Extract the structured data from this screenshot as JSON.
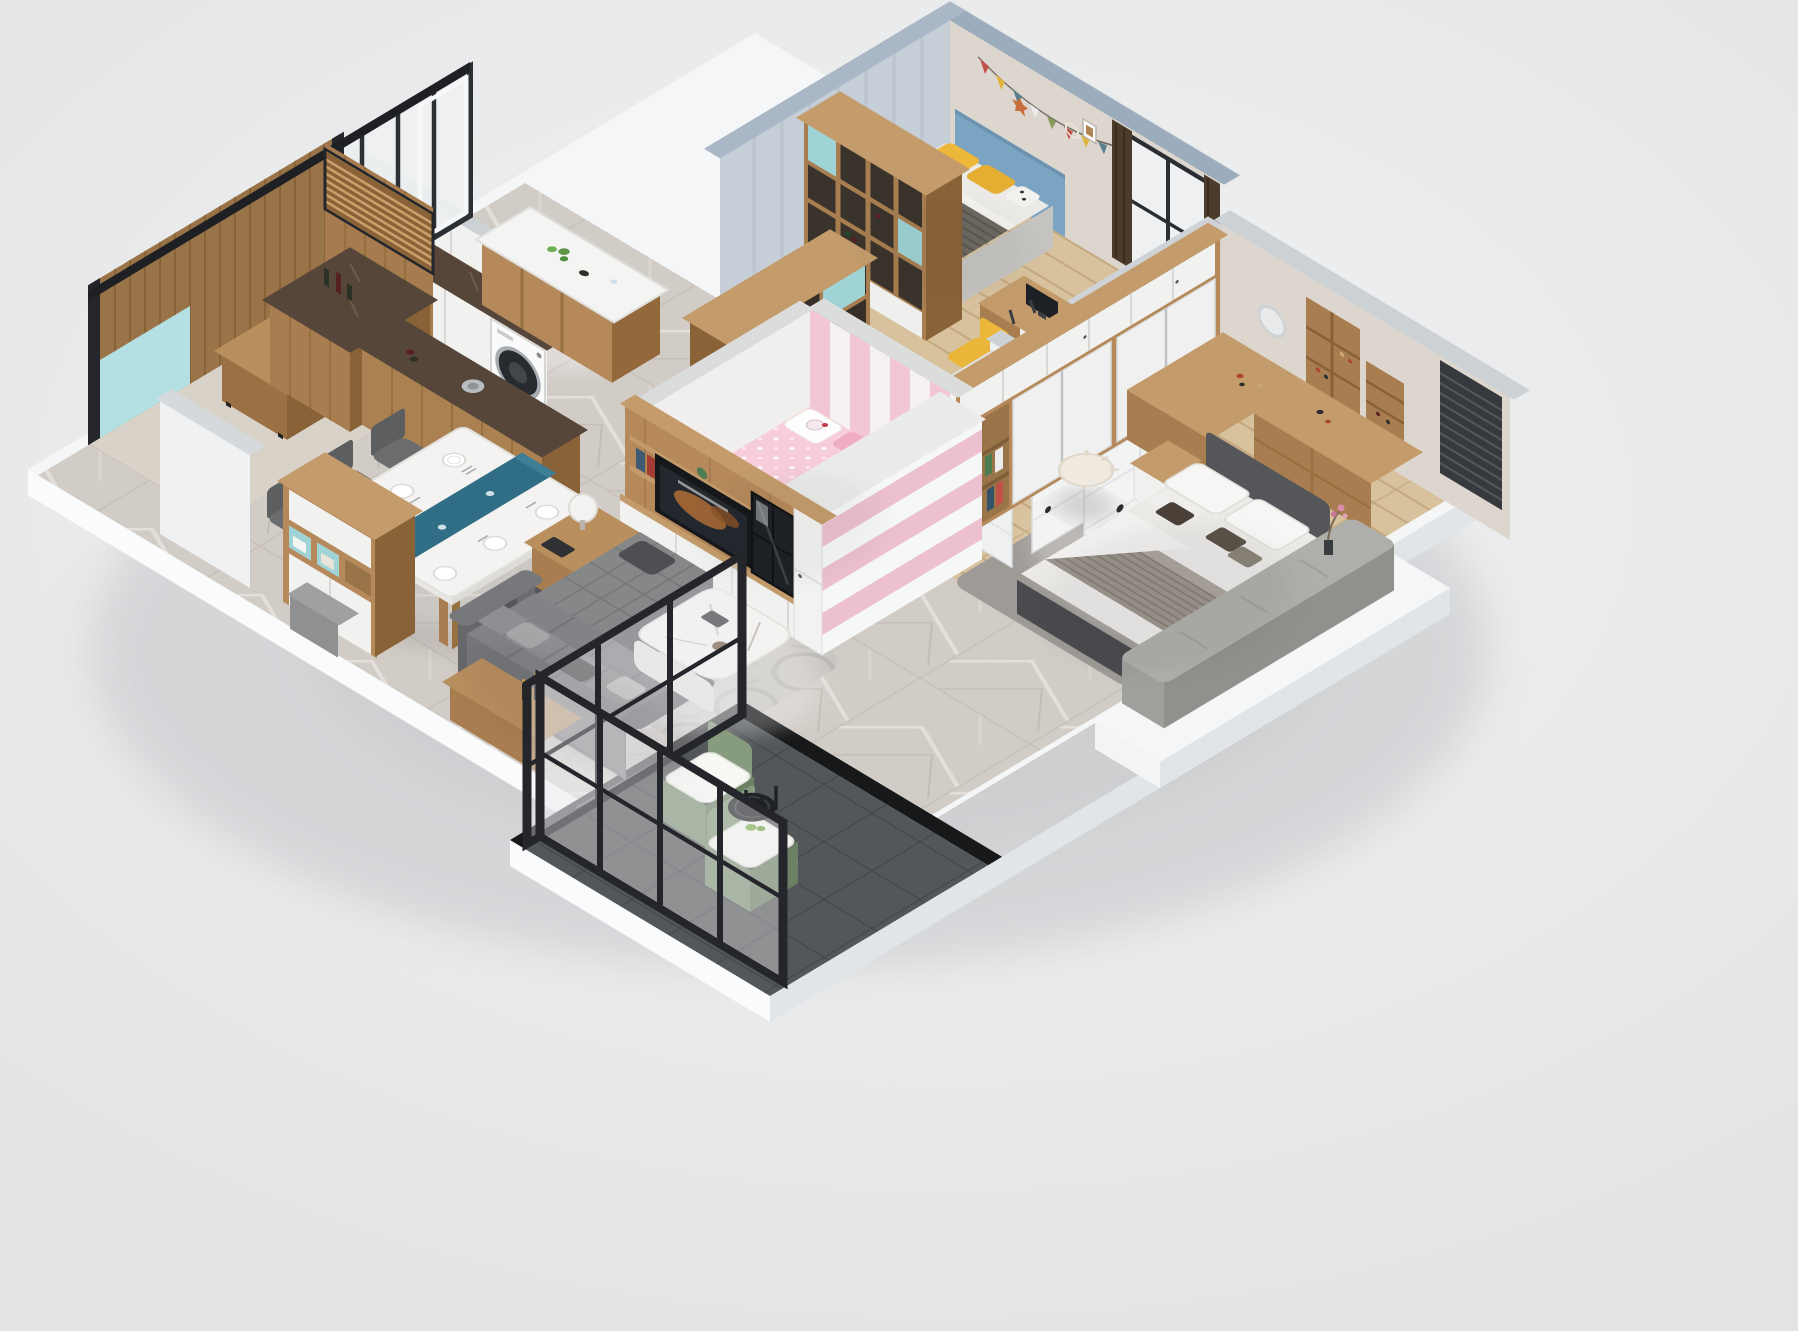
{
  "scene": {
    "type": "isometric-3d-apartment-floorplan-render",
    "description": "Cutaway d​ollhouse-style 3D render of a furnished apartment viewed from above at an angle, on a plain light gray background. No text is visible in the image.",
    "rooms": [
      {
        "name": "living-room",
        "floor": "gray marble tile with patterned rug",
        "furniture": [
          "gray L-shaped sectional sofa",
          "chaise lounge",
          "white organic marble coffee table",
          "wood side table with white ball lamp",
          "wood console with candlesticks"
        ]
      },
      {
        "name": "dining-area",
        "floor": "gray marble tile",
        "furniture": [
          "white stone dining table",
          "teal table runner",
          "six dark gray chairs",
          "place settings"
        ]
      },
      {
        "name": "kitchen",
        "floor": "gray marble tile",
        "furniture": [
          "white base cabinets",
          "washing machine",
          "dark marble countertop",
          "white upper cabinets",
          "island with white top and wine bottles",
          "tall wood wine shelf with teal cubbies"
        ]
      },
      {
        "name": "tea-room",
        "floor": "light stone",
        "furniture": [
          "herringbone wood panel walls",
          "slatted wood screen",
          "light blue accent panel",
          "wood tea table with tea set and green fruit"
        ]
      },
      {
        "name": "entry",
        "floor": "gray marble tile",
        "furniture": [
          "white and wood shoe cabinet with teal open cubbies",
          "gray bench cushion",
          "white stub wall"
        ]
      },
      {
        "name": "hallway",
        "floor": "gray marble tile",
        "furniture": [
          "four white doors with black hardware dots"
        ]
      },
      {
        "name": "kids-bedroom",
        "floor": "light wood plank",
        "furniture": [
          "bed with blue headboard and yellow pillows",
          "striped gray blanket",
          "wall bunting and star decor",
          "wood cubby divider shelf",
          "desk with monitor",
          "yellow chair",
          "blue bookshelf",
          "rhino poster",
          "dark brown curtains",
          "dark window blind"
        ]
      },
      {
        "name": "girls-bedroom",
        "floor": "pale wood",
        "furniture": [
          "white bed with pink Hello-Kitty bedding",
          "pink and white striped wardrobe",
          "pink striped accent wall"
        ]
      },
      {
        "name": "master-bedroom",
        "floor": "light wood plank with gray rug",
        "furniture": [
          "large wood-framed wardrobe with white sliding doors",
          "corner vanity desk with round mirror and cosmetics",
          "ribbed cream pouf",
          "white nightstand",
          "double bed with dark upholstered frame, white duvet, striped gray blanket and dark accent pillows",
          "gray upholstered window bench",
          "flower vase",
          "dark window blind"
        ]
      },
      {
        "name": "balcony",
        "floor": "dark gray tile with black marble border",
        "furniture": [
          "black metal framed glass partitions",
          "two green armchairs with white cushions",
          "small round black table"
        ]
      }
    ],
    "walls": {
      "cut_wall_caps": [
        "blue-gray over kids bedroom",
        "light gray elsewhere"
      ],
      "exterior": "white plinth slab under all floors"
    }
  },
  "palette": {
    "bg": "#ecedee",
    "plinth": "#f4f6f7",
    "plinth-side": "#e3e6e8",
    "cap-blue": "#9dacbd",
    "cap-gray": "#ccd1d6",
    "wall": "#dcd6ce",
    "wall-white": "#edeff0",
    "wood": "#a87e50",
    "wood-dark": "#8a6238",
    "wood-mid": "#b5895a",
    "wood-light": "#c49c6b",
    "wood-floor": "#d8c29e",
    "marble": "#d2ccc7",
    "counter-dark": "#564639",
    "white-panel": "#f1f1ef",
    "tile-dark": "#54575a",
    "black-marble": "#16181a",
    "frame-black": "#24262b",
    "sofa": "#828386",
    "sofa-dark": "#6b6c6f",
    "teal": "#9fd3d5",
    "runner": "#2f6e84",
    "pink": "#f7cddb",
    "pink-deep": "#ecc0cf",
    "yellow": "#edb73a",
    "green": "#7e9376",
    "glass": "#eef0f1",
    "rug": "#9e9a96",
    "bedding": "#eceae7",
    "blanket": "#9a948c",
    "blue-headboard": "#7ba3c2",
    "curtain": "#4a3b2b"
  }
}
